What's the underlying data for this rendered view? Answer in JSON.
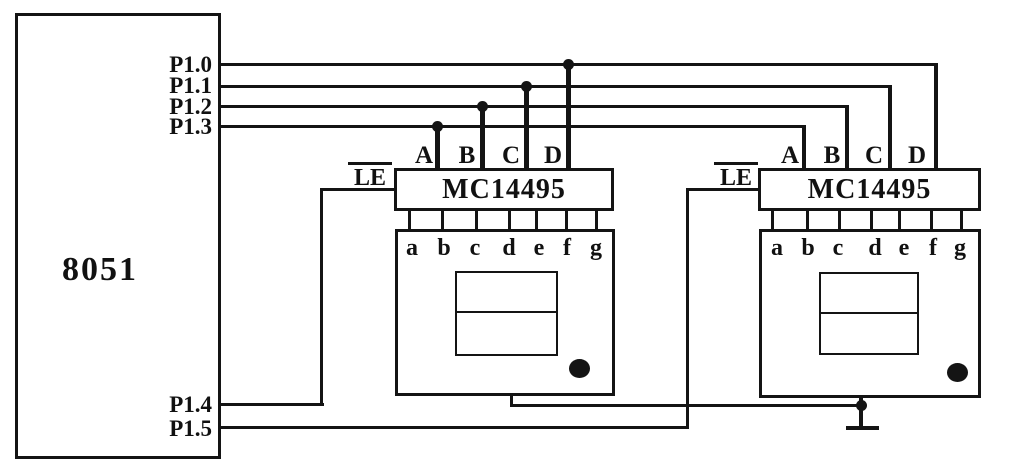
{
  "mcu": {
    "label": "8051",
    "top_pins": [
      "P1.0",
      "P1.1",
      "P1.2",
      "P1.3"
    ],
    "bottom_pins": [
      "P1.4",
      "P1.5"
    ]
  },
  "decoders": [
    {
      "chip_label": "MC14495",
      "latch_label": "LE",
      "inputs": [
        "A",
        "B",
        "C",
        "D"
      ],
      "segments": [
        "a",
        "b",
        "c",
        "d",
        "e",
        "f",
        "g"
      ]
    },
    {
      "chip_label": "MC14495",
      "latch_label": "LE",
      "inputs": [
        "A",
        "B",
        "C",
        "D"
      ],
      "segments": [
        "a",
        "b",
        "c",
        "d",
        "e",
        "f",
        "g"
      ]
    }
  ],
  "nets": [
    "P1.0 -> D input of both MC14495 (junction dot on left decoder tap)",
    "P1.1 -> C input of both MC14495",
    "P1.2 -> B input of both MC14495",
    "P1.3 -> A input of both MC14495",
    "P1.4 -> LE of left MC14495",
    "P1.5 -> LE of right MC14495",
    "display common pins -> ground symbol below right display"
  ],
  "colors": {
    "wire": "#141414",
    "background": "#ffffff"
  }
}
